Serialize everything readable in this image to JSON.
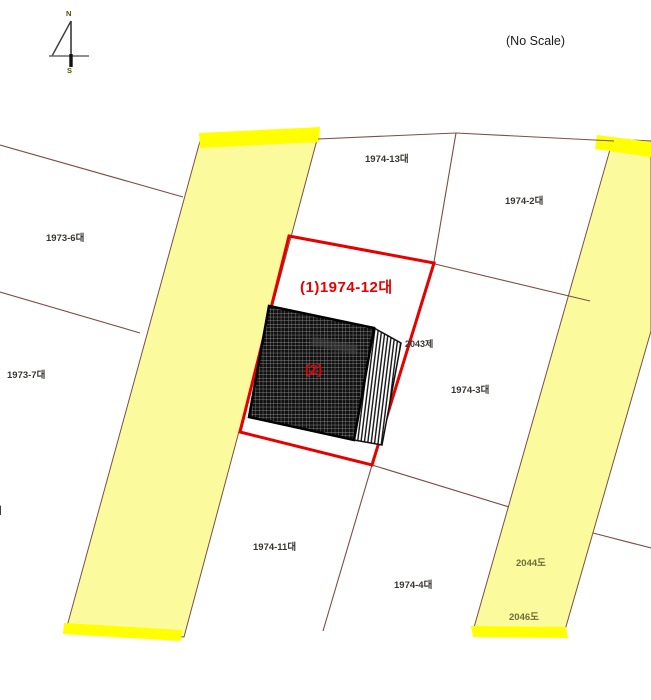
{
  "page": {
    "scale_note": "(No Scale)"
  },
  "compass": {
    "north_label": "N",
    "south_label": "S"
  },
  "subject": {
    "parcel_label": "(1)1974-12대",
    "building_label": "(2)"
  },
  "parcel_labels": {
    "p1973_6": "1973-6대",
    "p1973_7": "1973-7대",
    "p1974_13": "1974-13대",
    "p1974_2": "1974-2대",
    "p2043": "2043제",
    "p1974_3": "1974-3대",
    "p1974_11": "1974-11대",
    "p1974_4": "1974-4대",
    "r2044": "2044도",
    "r2046": "2046도",
    "edge_partial": "대"
  },
  "colors": {
    "road_fill": "#fbfb9d",
    "road_highlight": "#ffff00",
    "boundary_line": "#7a4f45",
    "subject_red": "#e60000",
    "building_fill": "#111111"
  }
}
